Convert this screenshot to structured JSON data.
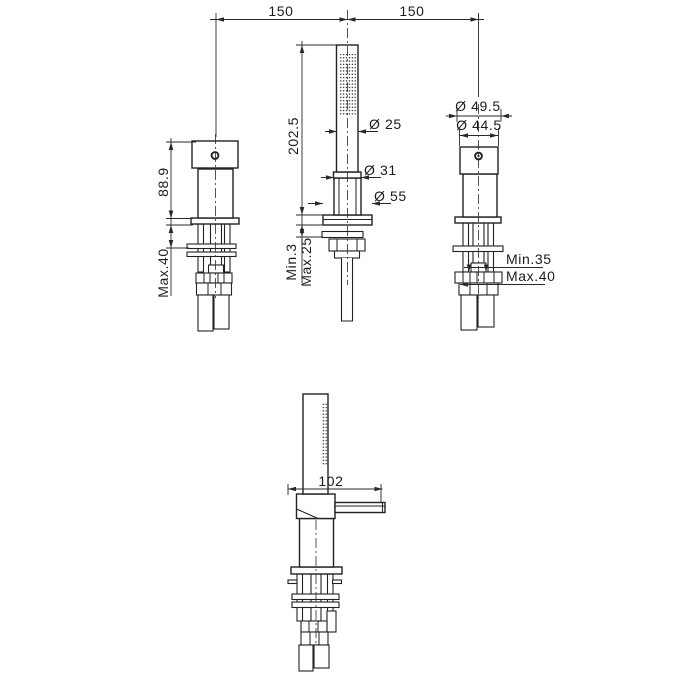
{
  "drawing": {
    "background_color": "#ffffff",
    "line_color": "#222222",
    "top_dimensions": {
      "span_left": "150",
      "span_right": "150"
    },
    "left_fixture": {
      "body_height": "88.9",
      "deck_thickness_max": "Max.40"
    },
    "middle_fixture": {
      "overall_height": "202.5",
      "handle_diameter": "Ø 25",
      "collar_diameter": "Ø 31",
      "base_diameter": "Ø 55",
      "deck_thickness_min": "Min.3",
      "deck_thickness_max": "Max.25"
    },
    "right_fixture": {
      "outer_diameter": "Ø 49.5",
      "inner_diameter": "Ø 44.5",
      "deck_thickness_min": "Min.35",
      "deck_thickness_max": "Max.40"
    },
    "side_view": {
      "spout_length": "102"
    }
  }
}
